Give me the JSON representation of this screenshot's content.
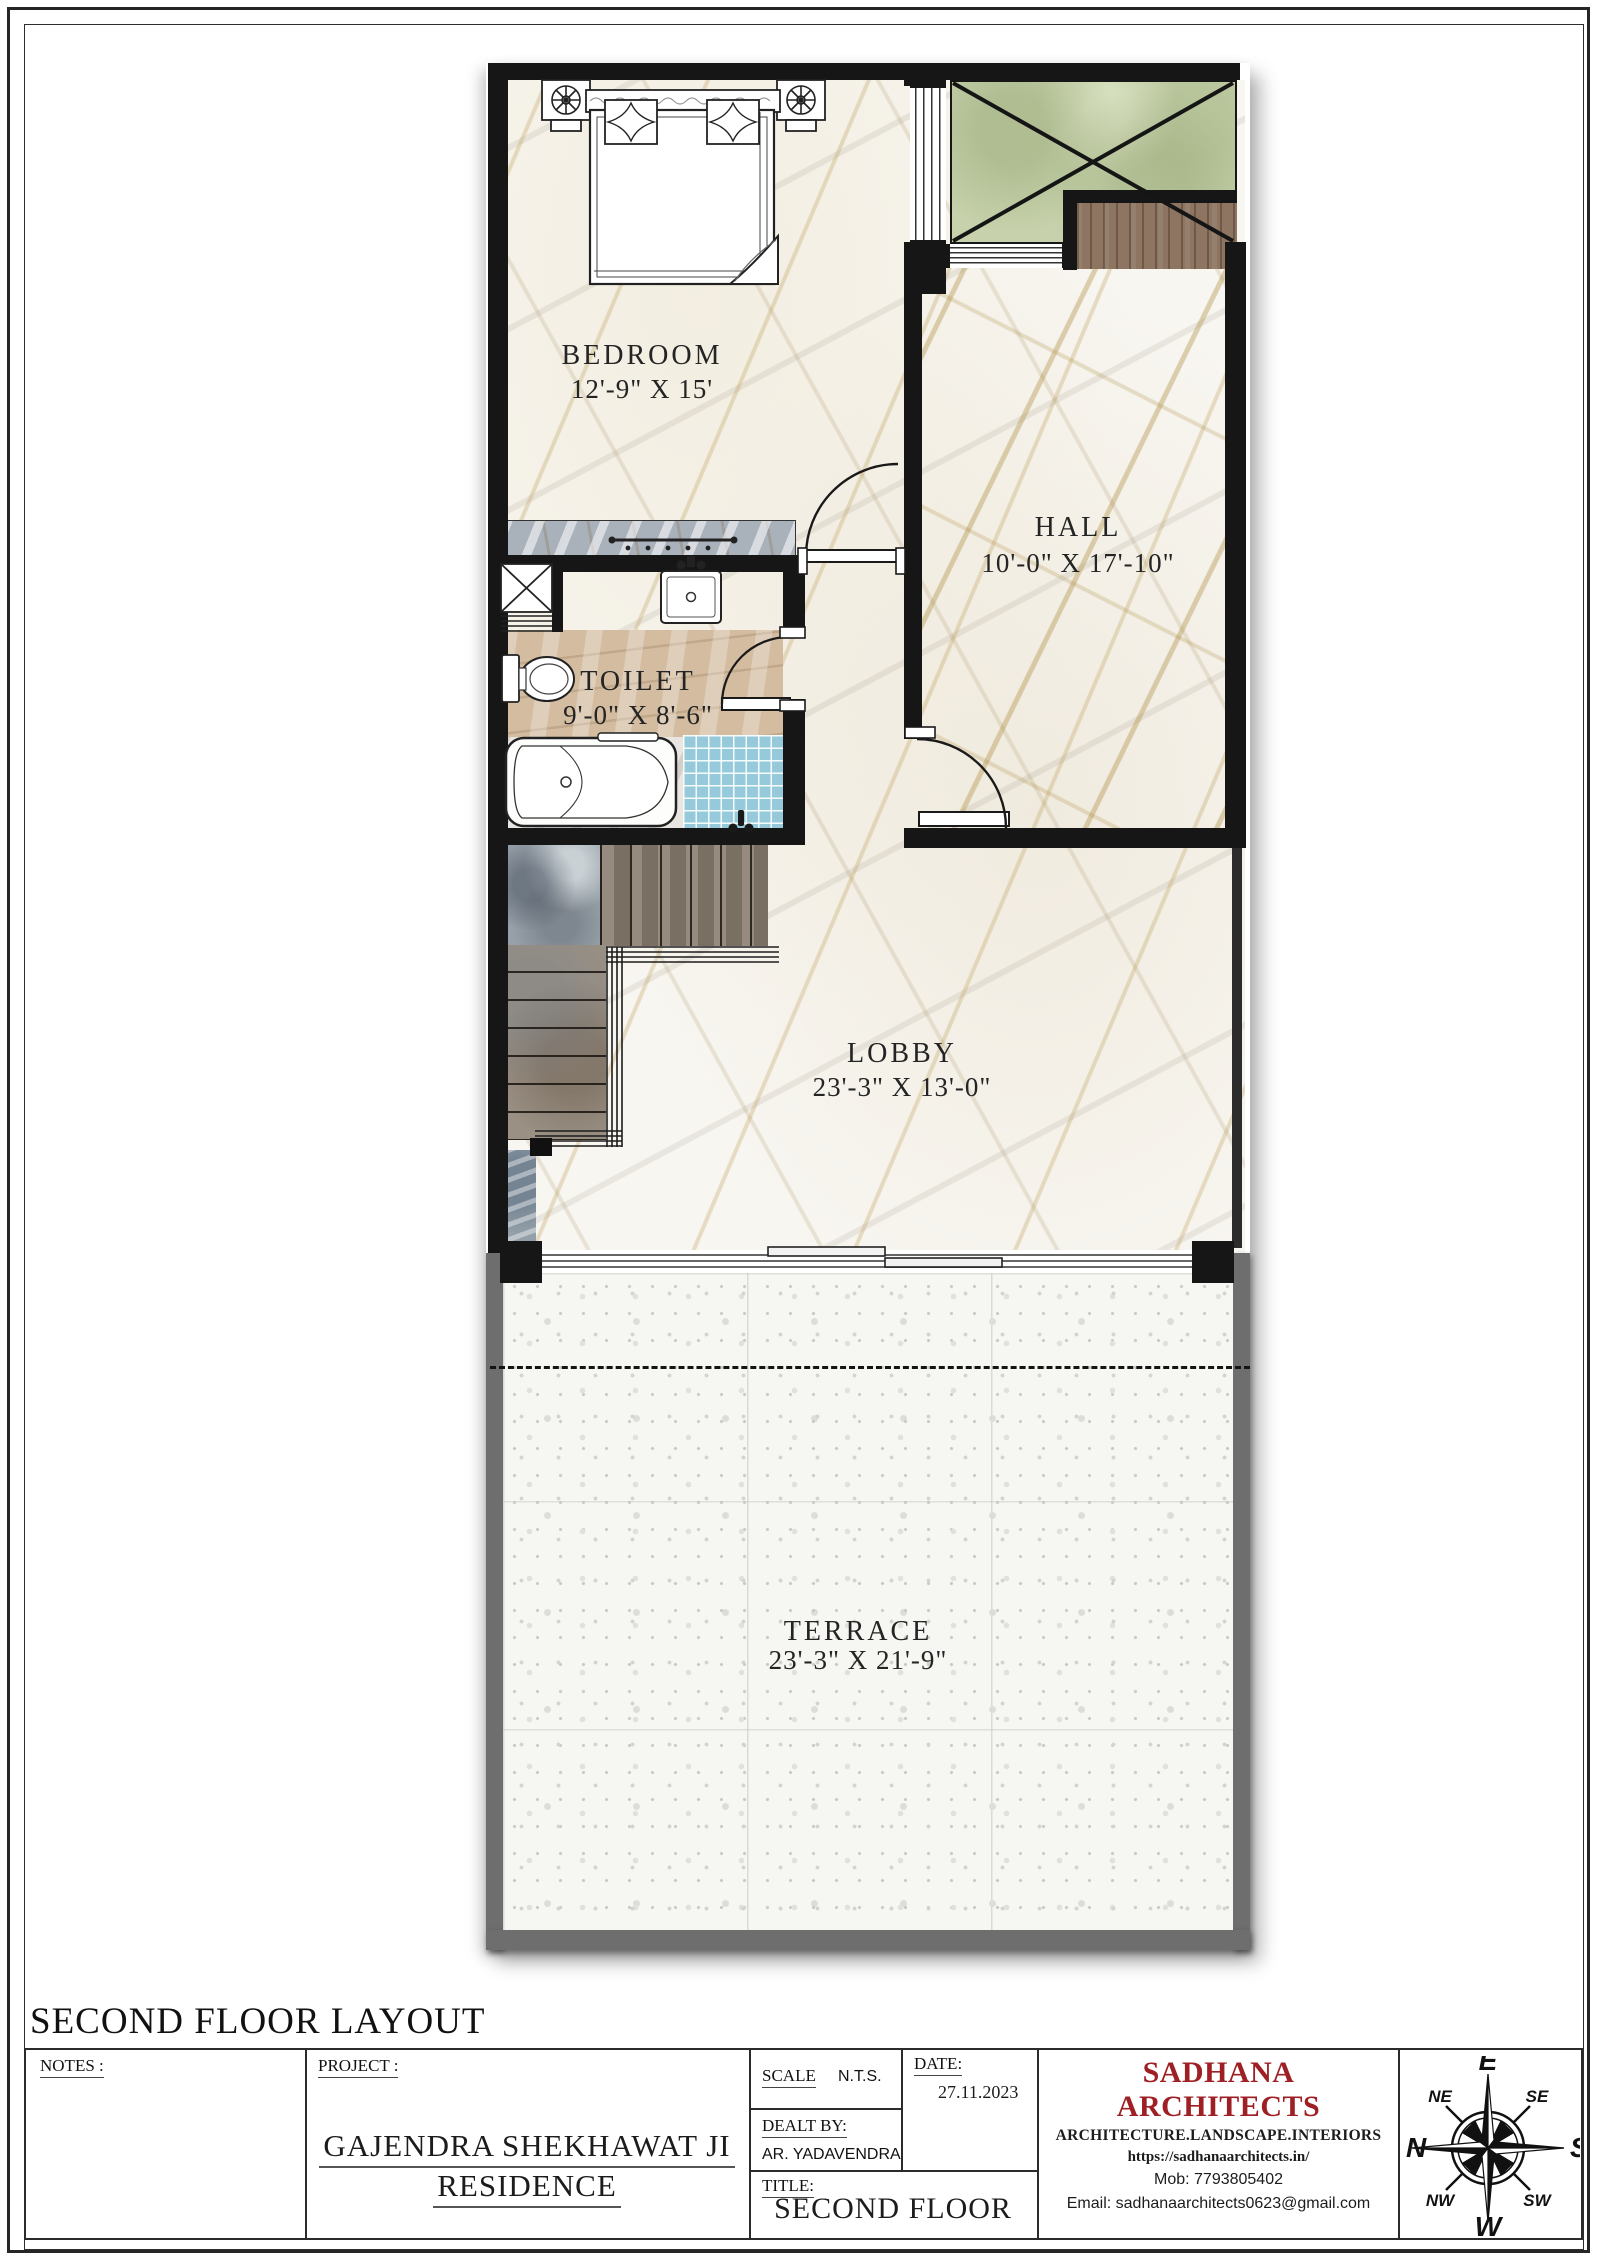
{
  "sheet": {
    "heading": "SECOND FLOOR LAYOUT"
  },
  "plan": {
    "rooms": {
      "bedroom": {
        "name": "BEDROOM",
        "dims": "12'-9\" X 15'"
      },
      "hall": {
        "name": "HALL",
        "dims": "10'-0\" X 17'-10\""
      },
      "toilet": {
        "name": "TOILET",
        "dims": "9'-0\" X 8'-6\""
      },
      "lobby": {
        "name": "LOBBY",
        "dims": "23'-3\" X 13'-0\""
      },
      "terrace": {
        "name": "TERRACE",
        "dims": "23'-3\" X 21'-9\""
      }
    }
  },
  "title_block": {
    "notes_label": "NOTES :",
    "project_label": "PROJECT :",
    "project_name_line1": "GAJENDRA SHEKHAWAT JI",
    "project_name_line2": "RESIDENCE",
    "scale_label": "SCALE",
    "scale_value": "N.T.S.",
    "date_label": "DATE:",
    "date_value": "27.11.2023",
    "dealt_by_label": "DEALT BY:",
    "dealt_by_value": "AR. YADAVENDRA",
    "title_label": "TITLE:",
    "title_value": "SECOND FLOOR"
  },
  "firm": {
    "name": "SADHANA ARCHITECTS",
    "tagline": "ARCHITECTURE.LANDSCAPE.INTERIORS",
    "website": "https://sadhanaarchitects.in/",
    "mobile": "Mob: 7793805402",
    "email": "Email: sadhanaarchitects0623@gmail.com",
    "accent_color": "#9e2024"
  },
  "compass": {
    "e": "E",
    "s": "S",
    "w": "W",
    "n": "N",
    "ne": "NE",
    "se": "SE",
    "sw": "SW",
    "nw": "NW"
  },
  "colors": {
    "wall": "#161616",
    "terrace_wall": "#6e6e6e",
    "balcony_green": "#c7d2ac",
    "deck_wood": "#8d7562",
    "shower_blue": "#96cada",
    "marble_vein_gold": "#ac8c3e"
  }
}
